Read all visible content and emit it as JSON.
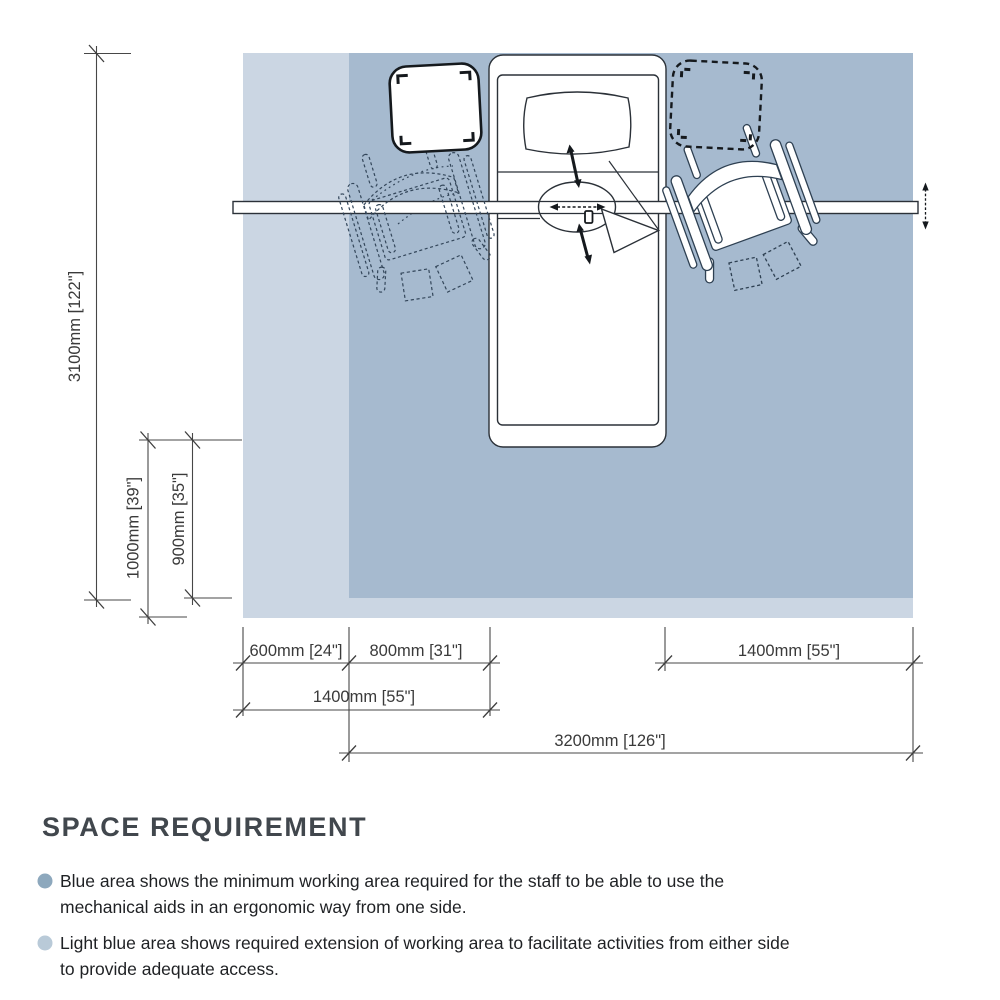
{
  "diagram": {
    "areas": {
      "working_color": "#a6bacf",
      "extension_color": "#cbd6e3"
    },
    "dimensions": {
      "total_depth": "3100mm [122\"]",
      "extension_depth": "1000mm [39\"]",
      "working_depth": "900mm [35\"]",
      "extension_width": "600mm [24\"]",
      "bed_side_clearance": "800mm [31\"]",
      "right_side_clearance": "1400mm [55\"]",
      "left_total_width": "1400mm [55\"]",
      "total_width": "3200mm [126\"]"
    }
  },
  "legend": {
    "title": "SPACE REQUIREMENT",
    "bullets": [
      {
        "color": "#8da8bd",
        "text": "Blue area shows the minimum working area required for the staff to be able to use the mechanical aids in an ergonomic way from one side."
      },
      {
        "color": "#b9cad8",
        "text": "Light blue area shows required extension of working area to facilitate activities from either side to provide adequate access."
      }
    ]
  }
}
